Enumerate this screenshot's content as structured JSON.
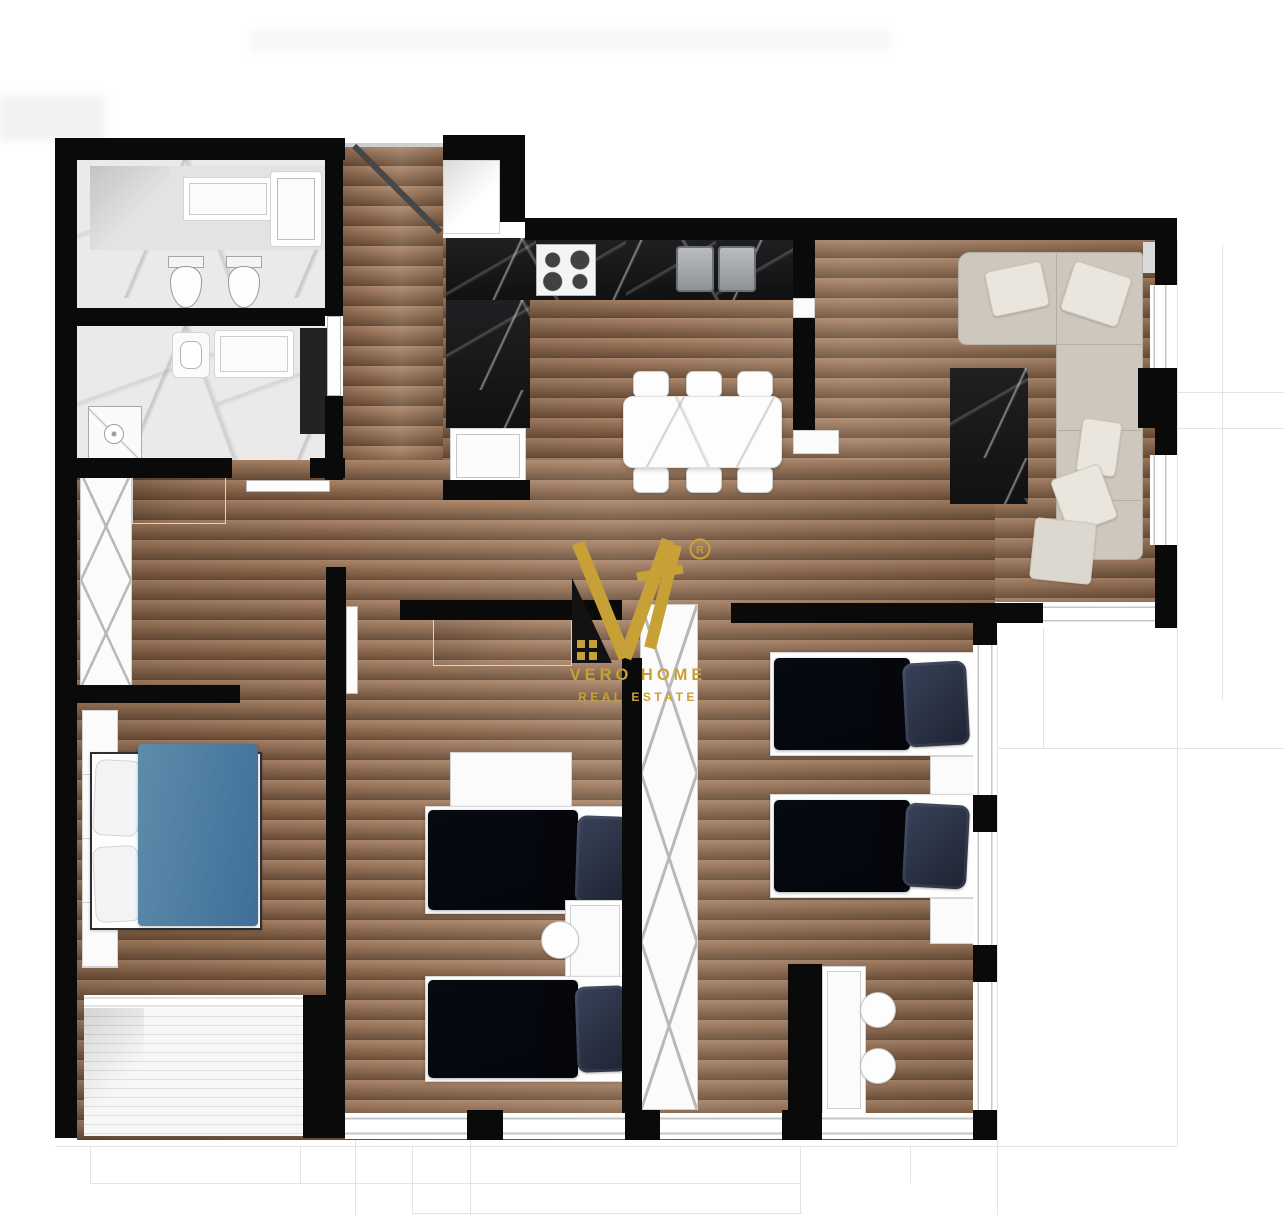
{
  "document": {
    "kind": "apartment-floor-plan-render",
    "background": "#ffffff"
  },
  "watermark": {
    "line1": "VERO HOME",
    "line2": "REAL ESTATE",
    "registered": "R",
    "gold": "#C8A136",
    "house_color": "#121212"
  },
  "palette": {
    "wall": "#0a0a0a",
    "wood": "#8d6b51",
    "wood_light": "#a8856a",
    "wood_dark": "#6b4f3a",
    "marble_light": "#eceae8",
    "marble_dark": "#161618",
    "bed_navy": "#272e3e",
    "bed_navy_dark": "#1d2330",
    "bed_blue": "#4f7da1",
    "sofa": "#cdc7bd",
    "deck": "#f1f1f1",
    "faint_line": "#e3e3e3",
    "white_furniture": "#fbfbfb"
  },
  "legend": {
    "rooms": [
      {
        "id": "bathroom-1",
        "furnishings": [
          "vanity",
          "bathtub",
          "toilet",
          "bidet"
        ]
      },
      {
        "id": "bathroom-2",
        "furnishings": [
          "washbasin",
          "counter",
          "shower",
          "dark-cabinet"
        ]
      },
      {
        "id": "entry-hall",
        "furnishings": [
          "entry-door",
          "storage-niche"
        ]
      },
      {
        "id": "kitchen",
        "furnishings": [
          "dark-marble-l-counter",
          "hob",
          "double-sink",
          "sink-cabinet"
        ]
      },
      {
        "id": "living-dining",
        "furnishings": [
          "marble-dining-table",
          "six-chairs",
          "corner-sofa",
          "cushions",
          "dark-marble-media-table"
        ]
      },
      {
        "id": "hallway",
        "furnishings": [
          "x-front-wardrobe",
          "closet"
        ]
      },
      {
        "id": "bedroom-1",
        "furnishings": [
          "double-bed-blue",
          "wardrobe",
          "balcony-deck"
        ]
      },
      {
        "id": "bedroom-2",
        "furnishings": [
          "single-bed-navy",
          "single-bed-navy",
          "desk",
          "chair",
          "dressers"
        ]
      },
      {
        "id": "bedroom-3",
        "furnishings": [
          "single-bed-navy",
          "single-bed-navy",
          "nightstands",
          "desk",
          "two-chairs",
          "x-front-wardrobe"
        ]
      }
    ]
  }
}
